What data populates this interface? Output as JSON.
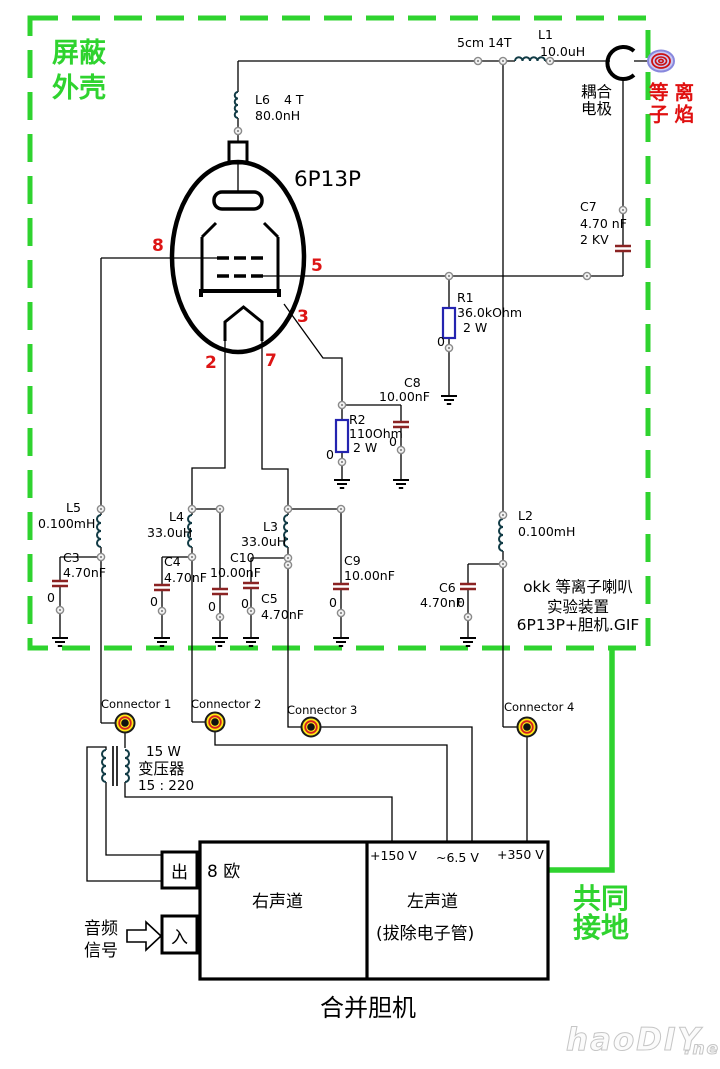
{
  "shield": {
    "line1": "屏蔽",
    "line2": "外壳"
  },
  "topline": {
    "coil": "5cm 14T",
    "l1_ref": "L1",
    "l1_val": "10.0uH",
    "l6_ref": "L6",
    "l6_turns": "4 T",
    "l6_val": "80.0nH",
    "electrode1": "耦合",
    "electrode2": "电极",
    "plasma1": "等离",
    "plasma2": "子焰"
  },
  "tube": {
    "model": "6P13P",
    "pin8": "8",
    "pin5": "5",
    "pin3": "3",
    "pin2": "2",
    "pin7": "7"
  },
  "parts": {
    "r1": {
      "ref": "R1",
      "val": "36.0kOhm",
      "pw": "2 W"
    },
    "r2": {
      "ref": "R2",
      "val": "110Ohm",
      "pw": "2 W"
    },
    "c3": {
      "ref": "C3",
      "val": "4.70nF"
    },
    "c4": {
      "ref": "C4",
      "val": "4.70nF"
    },
    "c5": {
      "ref": "C5",
      "val": "4.70nF"
    },
    "c6": {
      "ref": "C6",
      "val": "4.70nF"
    },
    "c7": {
      "ref": "C7",
      "val": "4.70 nF",
      "kv": "2 KV"
    },
    "c8": {
      "ref": "C8",
      "val": "10.00nF"
    },
    "c9": {
      "ref": "C9",
      "val": "10.00nF"
    },
    "c10": {
      "ref": "C10",
      "val": "10.00nF"
    },
    "l2": {
      "ref": "L2",
      "val": "0.100mH"
    },
    "l3": {
      "ref": "L3",
      "val": "33.0uH"
    },
    "l4": {
      "ref": "L4",
      "val": "33.0uH"
    },
    "l5": {
      "ref": "L5",
      "val": "0.100mH"
    },
    "zero": "0"
  },
  "note": {
    "line1": "okk 等离子喇叭",
    "line2": "实验装置",
    "line3": "6P13P+胆机.GIF"
  },
  "connectors": {
    "c1": "Connector 1",
    "c2": "Connector 2",
    "c3": "Connector 3",
    "c4": "Connector 4"
  },
  "transformer": {
    "power": "15 W",
    "name": "变压器",
    "ratio": "15 : 220"
  },
  "amp": {
    "v150": "+150 V",
    "v65": "~6.5 V",
    "v350": "+350 V",
    "ohm": "8 欧",
    "right": "右声道",
    "left": "左声道",
    "left_note": "(拔除电子管)",
    "out": "出",
    "in": "入",
    "audio1": "音频",
    "audio2": "信号",
    "title": "合并胆机"
  },
  "ground": {
    "line1": "共同",
    "line2": "接地"
  },
  "colors": {
    "shield_green": "#2fd32f",
    "plasma_red": "#e01010",
    "cap_maroon": "#8b2323",
    "resistor_blue": "#2424b0",
    "connector_yellow": "#ffe818"
  },
  "watermark": {
    "main": "haoDIY",
    "suffix": ".net"
  }
}
